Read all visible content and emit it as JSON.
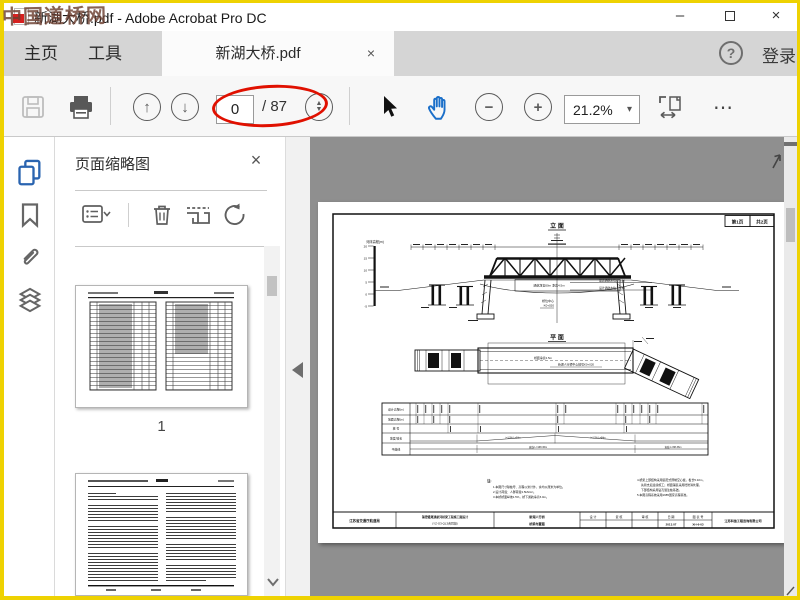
{
  "window": {
    "title": "新湖大桥.pdf - Adobe Acrobat Pro DC",
    "minimize": "–",
    "close": "×"
  },
  "watermark": "中国道桥网",
  "tabbar": {
    "home": "主页",
    "tools": "工具",
    "doc_title": "新湖大桥.pdf",
    "doc_close": "×",
    "help": "?",
    "sign_in": "登录"
  },
  "toolbar": {
    "page_value": "0",
    "page_total": "/ 87",
    "zoom_value": "21.2%",
    "more": "⋯"
  },
  "icons": {
    "caret_down": "▾",
    "arrow_up": "↑",
    "arrow_down": "↓",
    "minus": "−",
    "plus": "+",
    "tri_up": "▲",
    "tri_down": "▼"
  },
  "panel": {
    "title": "页面缩略图",
    "close": "×",
    "page1_label": "1"
  },
  "drawing": {
    "sheet_no": "第1页",
    "sheet_total": "共2页",
    "elevation_title": "立 面",
    "plan_title": "平 面",
    "scale_label": "河床高程(m)",
    "scale_ticks": [
      "20",
      "15",
      "10",
      "5",
      "0",
      "-5"
    ],
    "water_level_1": "最高通航水位 ▽2.50",
    "water_level_2": "设计通航水位 ▽1.80",
    "clearance_label": "通航净宽60m 净高4.5m",
    "center_label_1": "桥位中心",
    "center_label_2": "K0+020",
    "deck_width_label": "桥面净宽4.5m",
    "plan_center_label": "新湖人行桥中心桩号K0+020",
    "profile_rows": [
      "设计高程(m)",
      "地面高程(m)",
      "桩  号",
      "坡度/坡长",
      "平曲线"
    ],
    "grade_left": "i=1.5% L=84m",
    "grade_right": "i=1.5% L=84m",
    "curve_left": "直线 L=168.36m",
    "curve_right": "直线 L=88.36m",
    "notes_title": "注:",
    "notes_left": [
      "1.本图尺寸除桩号、高程以米计外，余均以厘米为单位。",
      "2.设计荷载：人群荷载3.5kN/m²。",
      "3.本桥桥面纵坡1.5%，桥下通航净高5.0m。"
    ],
    "notes_right": [
      "4.桥梁上部结构采用装配式预制空心板，板长5.32m，",
      "先简支后连续施工；桥面铺装采用砼防滑处理，",
      "下部结构采用钻孔灌注桩基础。",
      "5.本图高程系统采用1985国家高程基准。"
    ],
    "titleblock": {
      "c1": "江苏省交通厅航道局",
      "c2a": "锡澄灌溉通航河桥梁工程施工图设计",
      "c2b": "(YZ-G3-QL3合同段)",
      "c3a": "新湖人行桥",
      "c3b": "桥梁布置图",
      "design": "设  计",
      "check": "复  核",
      "review": "审  核",
      "date_label": "日  期",
      "date": "2013.07",
      "no_label": "图 表 号",
      "no": "XH-6-03",
      "company": "江苏科信工程咨询有限公司"
    }
  }
}
